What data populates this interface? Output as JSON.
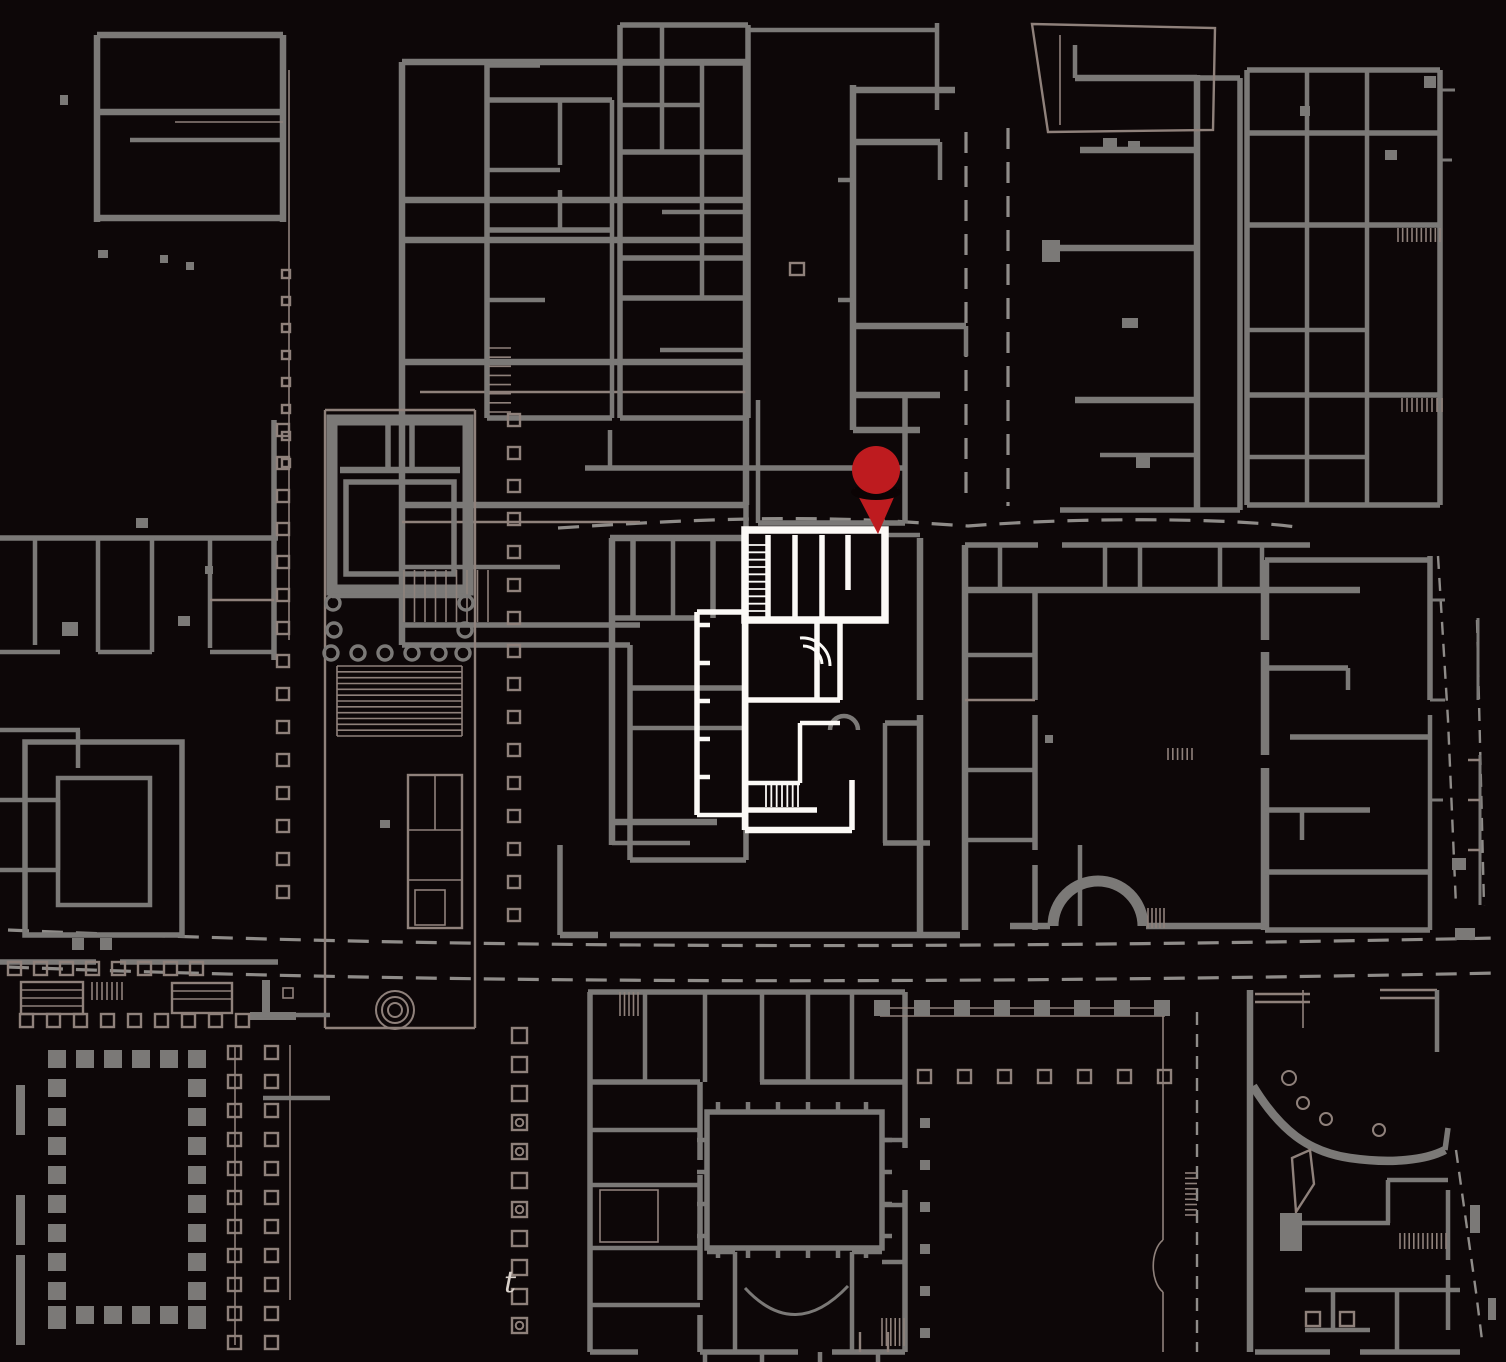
{
  "map": {
    "colors": {
      "bg": "#0D0708",
      "wall": "#7B7977",
      "outline": "#8F817B",
      "dash": "#8F8C89",
      "hl": "#FBF9F6",
      "pin": "#BE1B1F",
      "pinshadow": "#0B0304",
      "label": "#D8D0CA"
    },
    "pin": {
      "cx": 876,
      "cy": 470,
      "r": 24,
      "tip_x": 878,
      "tip_y": 534
    },
    "street_label": "t",
    "colonnades": [
      {
        "x": 277,
        "y": 424,
        "dy": 33,
        "n": 15,
        "s": 12,
        "st": "o"
      },
      {
        "x": 508,
        "y": 414,
        "dy": 33,
        "n": 16,
        "s": 12,
        "st": "o"
      },
      {
        "x": 512,
        "y": 1028,
        "dy": 29,
        "n": 11,
        "s": 15,
        "st": "o",
        "dots": [
          3,
          4,
          6,
          10
        ]
      },
      {
        "x": 48,
        "y": 1050,
        "dy": 29,
        "n": 10,
        "s": 18,
        "st": "f"
      },
      {
        "x": 188,
        "y": 1050,
        "dy": 29,
        "n": 10,
        "s": 18,
        "st": "f"
      },
      {
        "x": 48,
        "y": 1050,
        "dx": 28,
        "n": 6,
        "s": 18,
        "st": "f"
      },
      {
        "x": 48,
        "y": 1306,
        "dx": 28,
        "n": 6,
        "s": 18,
        "st": "f"
      },
      {
        "x": 228,
        "y": 1046,
        "dy": 29,
        "n": 11,
        "s": 13,
        "st": "o"
      },
      {
        "x": 265,
        "y": 1046,
        "dy": 29,
        "n": 11,
        "s": 13,
        "st": "o"
      },
      {
        "x": 20,
        "y": 1014,
        "dx": 27,
        "n": 9,
        "s": 13,
        "st": "o"
      },
      {
        "x": 8,
        "y": 962,
        "dx": 26,
        "n": 8,
        "s": 13,
        "st": "o"
      },
      {
        "x": 282,
        "y": 270,
        "dy": 27,
        "n": 8,
        "s": 8,
        "st": "o"
      },
      {
        "x": 874,
        "y": 1000,
        "dx": 40,
        "n": 8,
        "s": 16,
        "st": "f"
      },
      {
        "x": 918,
        "y": 1070,
        "dx": 40,
        "n": 7,
        "s": 13,
        "st": "o"
      },
      {
        "x": 920,
        "y": 1118,
        "dy": 42,
        "n": 6,
        "s": 10,
        "st": "f"
      },
      {
        "x": 1306,
        "y": 1312,
        "dx": 34,
        "n": 2,
        "s": 14,
        "st": "o"
      }
    ],
    "hatches": [
      {
        "x": 337,
        "y": 666,
        "w": 125,
        "h": 70,
        "n": 13,
        "d": "h",
        "c": "o"
      },
      {
        "x": 404,
        "y": 570,
        "w": 84,
        "h": 52,
        "n": 9,
        "d": "v",
        "c": "o"
      },
      {
        "x": 489,
        "y": 348,
        "w": 22,
        "h": 64,
        "n": 8,
        "d": "h",
        "c": "o"
      },
      {
        "x": 748,
        "y": 545,
        "w": 18,
        "h": 66,
        "n": 10,
        "d": "h",
        "c": "hl"
      },
      {
        "x": 766,
        "y": 785,
        "w": 32,
        "h": 22,
        "n": 7,
        "d": "v",
        "c": "hl"
      },
      {
        "x": 620,
        "y": 992,
        "w": 18,
        "h": 24,
        "n": 5,
        "d": "v",
        "c": "o"
      },
      {
        "x": 882,
        "y": 1318,
        "w": 22,
        "h": 28,
        "n": 6,
        "d": "v",
        "c": "o"
      },
      {
        "x": 1400,
        "y": 1233,
        "w": 46,
        "h": 16,
        "n": 11,
        "d": "v",
        "c": "o"
      },
      {
        "x": 1148,
        "y": 908,
        "w": 16,
        "h": 20,
        "n": 5,
        "d": "v",
        "c": "o"
      },
      {
        "x": 92,
        "y": 982,
        "w": 30,
        "h": 18,
        "n": 7,
        "d": "v",
        "c": "o"
      },
      {
        "x": 1168,
        "y": 748,
        "w": 24,
        "h": 12,
        "n": 6,
        "d": "v",
        "c": "o"
      },
      {
        "x": 1185,
        "y": 1173,
        "w": 12,
        "h": 42,
        "n": 9,
        "d": "h",
        "c": "o"
      },
      {
        "x": 1398,
        "y": 228,
        "w": 42,
        "h": 14,
        "n": 10,
        "d": "v",
        "c": "o"
      },
      {
        "x": 1402,
        "y": 398,
        "w": 40,
        "h": 14,
        "n": 9,
        "d": "v",
        "c": "o"
      }
    ],
    "circles": [
      {
        "x": 333,
        "y": 603,
        "r": 7,
        "c": "cw"
      },
      {
        "x": 466,
        "y": 603,
        "r": 7,
        "c": "cw"
      },
      {
        "x": 334,
        "y": 630,
        "r": 7,
        "c": "cw"
      },
      {
        "x": 465,
        "y": 630,
        "r": 7,
        "c": "cw"
      },
      {
        "x": 331,
        "y": 653,
        "r": 7,
        "c": "cw"
      },
      {
        "x": 358,
        "y": 653,
        "r": 7,
        "c": "cw"
      },
      {
        "x": 385,
        "y": 653,
        "r": 7,
        "c": "cw"
      },
      {
        "x": 412,
        "y": 653,
        "r": 7,
        "c": "cw"
      },
      {
        "x": 439,
        "y": 653,
        "r": 7,
        "c": "cw"
      },
      {
        "x": 463,
        "y": 653,
        "r": 7,
        "c": "cw"
      },
      {
        "x": 395,
        "y": 1010,
        "r": 19,
        "c": "co"
      },
      {
        "x": 395,
        "y": 1010,
        "r": 13,
        "c": "co"
      },
      {
        "x": 395,
        "y": 1010,
        "r": 7,
        "c": "co"
      },
      {
        "x": 1289,
        "y": 1078,
        "r": 7,
        "c": "co"
      },
      {
        "x": 1303,
        "y": 1103,
        "r": 6,
        "c": "co"
      },
      {
        "x": 1326,
        "y": 1119,
        "r": 6,
        "c": "co"
      },
      {
        "x": 1379,
        "y": 1130,
        "r": 6,
        "c": "co"
      }
    ]
  }
}
